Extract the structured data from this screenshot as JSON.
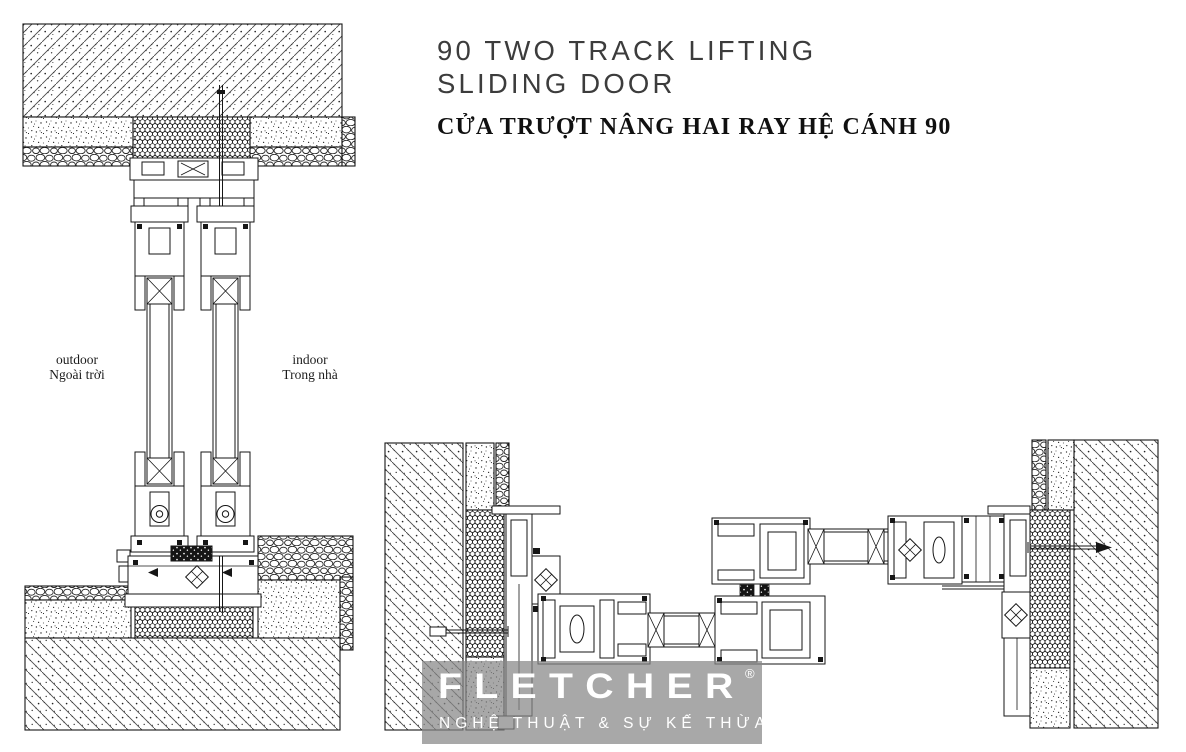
{
  "header": {
    "title_line1": "90 TWO TRACK LIFTING",
    "title_line2": "SLIDING DOOR",
    "subtitle_vi": "CỬA TRƯỢT NÂNG HAI RAY HỆ CÁNH 90"
  },
  "vertical_section": {
    "label_outdoor_en": "outdoor",
    "label_outdoor_vi": "Ngoài trời",
    "label_indoor_en": "indoor",
    "label_indoor_vi": "Trong nhà"
  },
  "logo": {
    "brand": "FLETCHER",
    "registered_mark": "®",
    "tagline": "NGHỆ THUẬT & SỰ KẾ THỪA"
  },
  "colors": {
    "drawing_line": "#161616",
    "title_text": "#3c3c3c",
    "subtitle_text": "#101010",
    "logo_box": "#868686",
    "logo_text": "#ffffff",
    "background": "#ffffff"
  }
}
